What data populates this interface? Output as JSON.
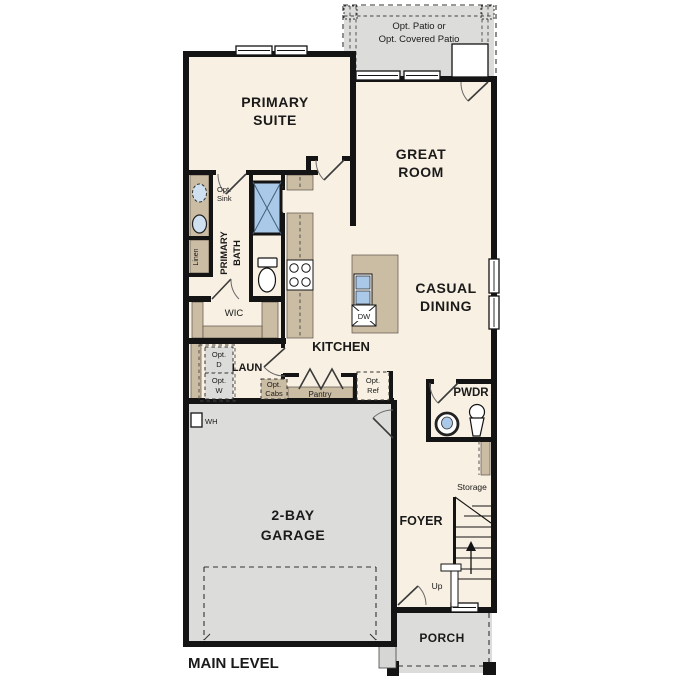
{
  "title": "MAIN LEVEL",
  "colors": {
    "wall": "#141414",
    "floor": "#f8f0e2",
    "exterior_gray": "#dcdcda",
    "counter_tan": "#cbbda3",
    "fixture_blue": "#aac9e9",
    "text": "#1a1a1a",
    "background": "#ffffff"
  },
  "rooms": {
    "patio": {
      "line1": "Opt. Patio or",
      "line2": "Opt. Covered Patio"
    },
    "primary_suite": {
      "line1": "PRIMARY",
      "line2": "SUITE"
    },
    "great_room": {
      "line1": "GREAT",
      "line2": "ROOM"
    },
    "casual_dining": {
      "line1": "CASUAL",
      "line2": "DINING"
    },
    "kitchen": {
      "label": "KITCHEN"
    },
    "primary_bath": {
      "line1": "PRIMARY",
      "line2": "BATH"
    },
    "wic": {
      "label": "WIC"
    },
    "laundry": {
      "label": "LAUN"
    },
    "pwdr": {
      "label": "PWDR"
    },
    "storage": {
      "label": "Storage"
    },
    "garage": {
      "line1": "2-BAY",
      "line2": "GARAGE"
    },
    "foyer": {
      "label": "FOYER"
    },
    "porch": {
      "label": "PORCH"
    }
  },
  "fixtures": {
    "opt_sink": {
      "line1": "Opt.",
      "line2": "Sink"
    },
    "linen": "Linen",
    "opt_dryer": {
      "line1": "Opt.",
      "line2": "D"
    },
    "opt_washer": {
      "line1": "Opt.",
      "line2": "W"
    },
    "opt_cabs": {
      "line1": "Opt.",
      "line2": "Cabs"
    },
    "pantry": "Pantry",
    "opt_ref": {
      "line1": "Opt.",
      "line2": "Ref"
    },
    "dishwasher": "DW",
    "water_heater": "WH",
    "stairs_up": "Up"
  }
}
